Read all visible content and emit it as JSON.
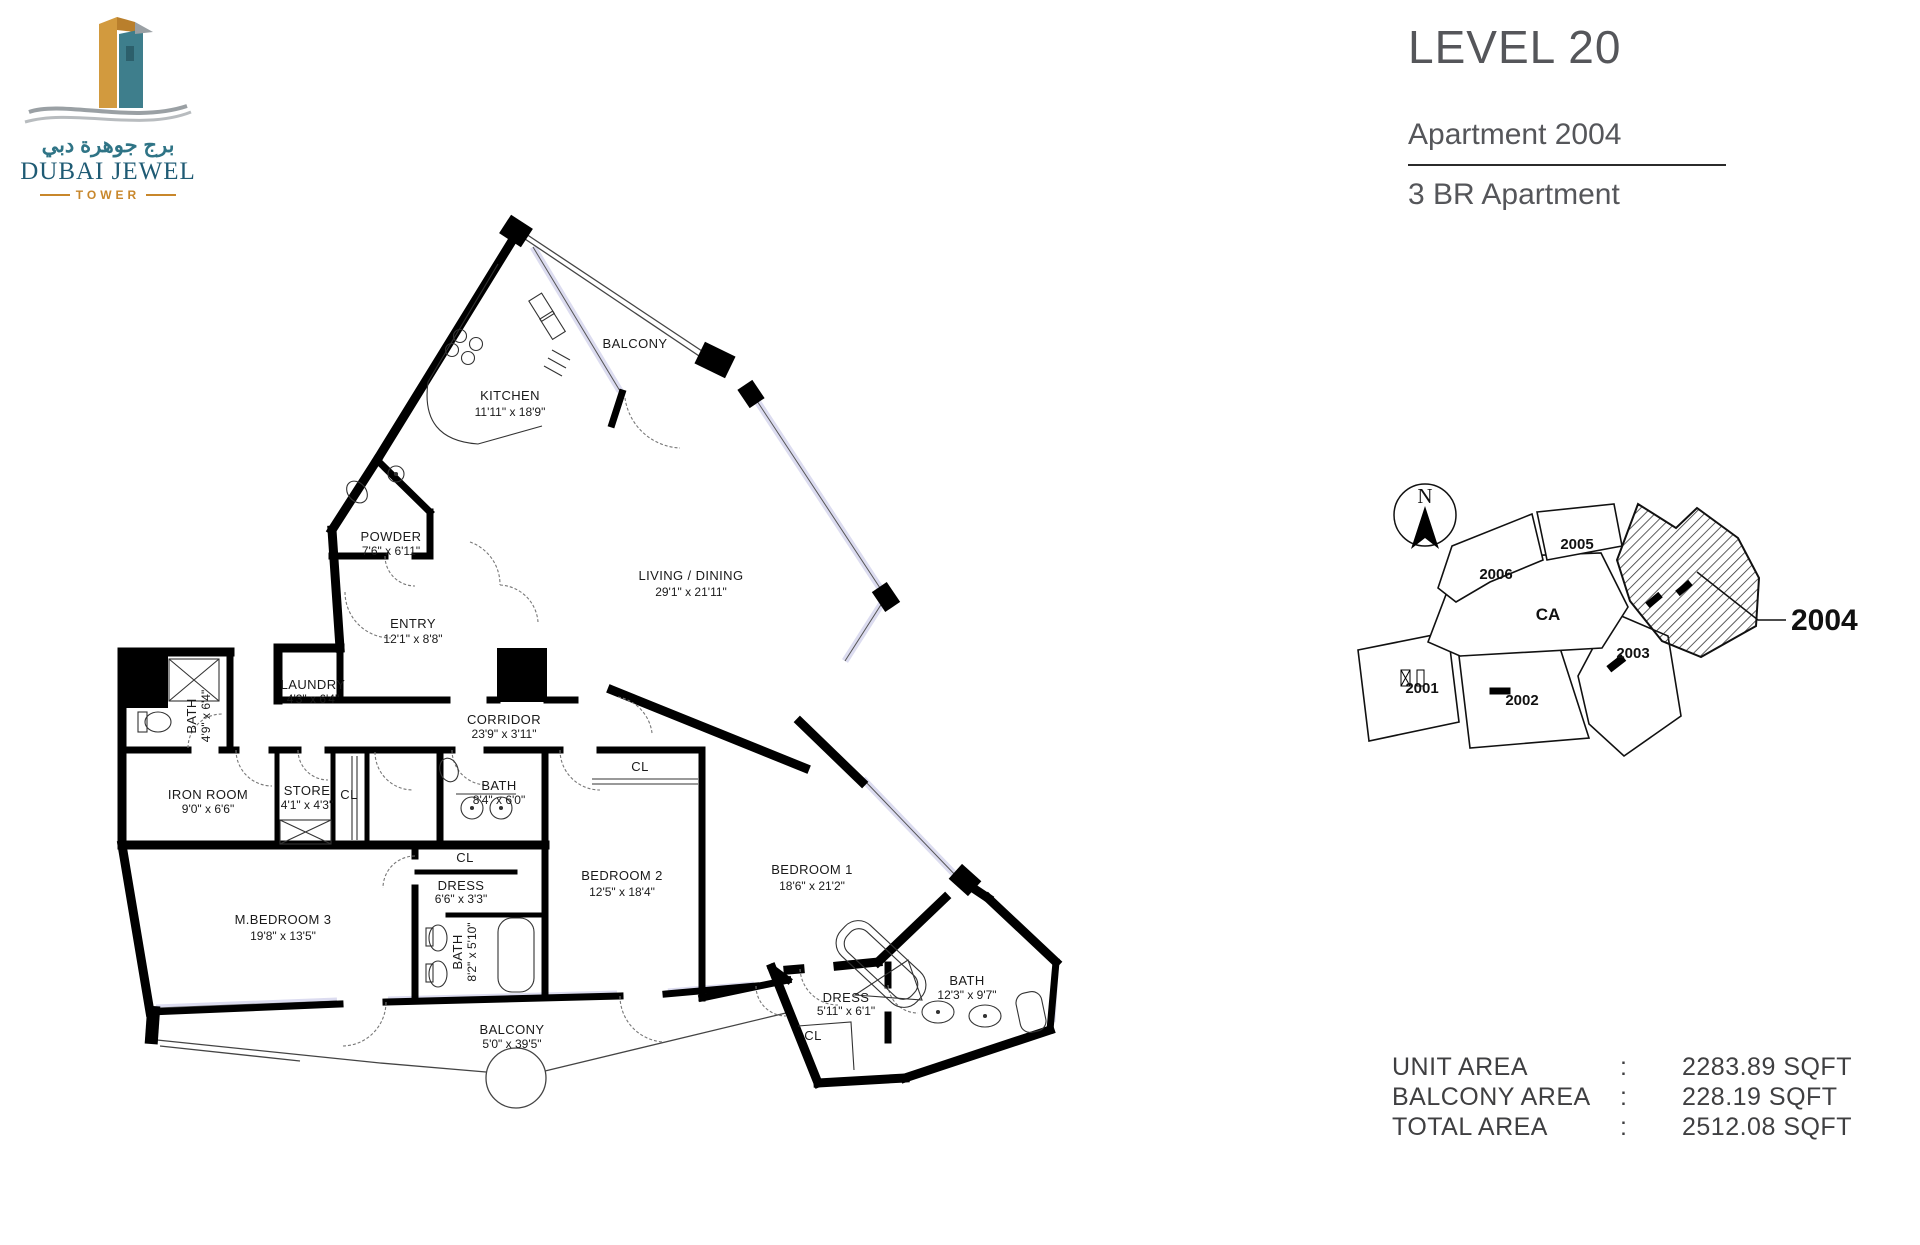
{
  "header": {
    "level": "LEVEL 20",
    "apartment": "Apartment 2004",
    "unit_type": "3 BR Apartment"
  },
  "logo": {
    "arabic": "برج جوهرة دبي",
    "name": "DUBAI JEWEL",
    "subtitle": "TOWER"
  },
  "plan": {
    "rooms": [
      {
        "name": "KITCHEN",
        "dims": "11'11\" x 18'9\""
      },
      {
        "name": "BALCONY",
        "dims": ""
      },
      {
        "name": "LIVING / DINING",
        "dims": "29'1\" x 21'11\""
      },
      {
        "name": "POWDER",
        "dims": "7'6\" x 6'11\""
      },
      {
        "name": "ENTRY",
        "dims": "12'1\" x 8'8\""
      },
      {
        "name": "LAUNDRY",
        "dims": "4'3\" x 6'4\""
      },
      {
        "name": "BATH",
        "dims": "4'9\" x 6'4\""
      },
      {
        "name": "CORRIDOR",
        "dims": "23'9\" x 3'11\""
      },
      {
        "name": "IRON ROOM",
        "dims": "9'0\" x 6'6\""
      },
      {
        "name": "STORE",
        "dims": "4'1\" x 4'3\""
      },
      {
        "name": "CL",
        "dims": ""
      },
      {
        "name": "BATH",
        "dims": "8'4\" x 6'0\""
      },
      {
        "name": "CL",
        "dims": ""
      },
      {
        "name": "BEDROOM 2",
        "dims": "12'5\" x 18'4\""
      },
      {
        "name": "BEDROOM 1",
        "dims": "18'6\" x 21'2\""
      },
      {
        "name": "M.BEDROOM 3",
        "dims": "19'8\" x 13'5\""
      },
      {
        "name": "CL",
        "dims": ""
      },
      {
        "name": "DRESS",
        "dims": "6'6\" x 3'3\""
      },
      {
        "name": "BATH",
        "dims": "8'2\" x 5'10\""
      },
      {
        "name": "BALCONY",
        "dims": "5'0\" x 39'5\""
      },
      {
        "name": "DRESS",
        "dims": "5'11\" x 6'1\""
      },
      {
        "name": "CL",
        "dims": ""
      },
      {
        "name": "BATH",
        "dims": "12'3\" x 9'7\""
      }
    ]
  },
  "keyplan": {
    "north": "N",
    "highlight": "2004",
    "units": {
      "u2001": "2001",
      "u2002": "2002",
      "u2003": "2003",
      "u2005": "2005",
      "u2006": "2006",
      "ca": "CA"
    }
  },
  "areas": {
    "rows": [
      {
        "label": "UNIT AREA",
        "colon": ":",
        "value": "2283.89 SQFT"
      },
      {
        "label": "BALCONY AREA",
        "colon": ":",
        "value": "228.19 SQFT"
      },
      {
        "label": "TOTAL AREA",
        "colon": ":",
        "value": "2512.08 SQFT"
      }
    ]
  },
  "colors": {
    "wall": "#000000",
    "window_fill": "#dcdcf0",
    "text_dark": "#55565a",
    "logo_teal": "#2f7486",
    "logo_gold": "#c8872b",
    "plan_text": "#1a1a1a"
  }
}
